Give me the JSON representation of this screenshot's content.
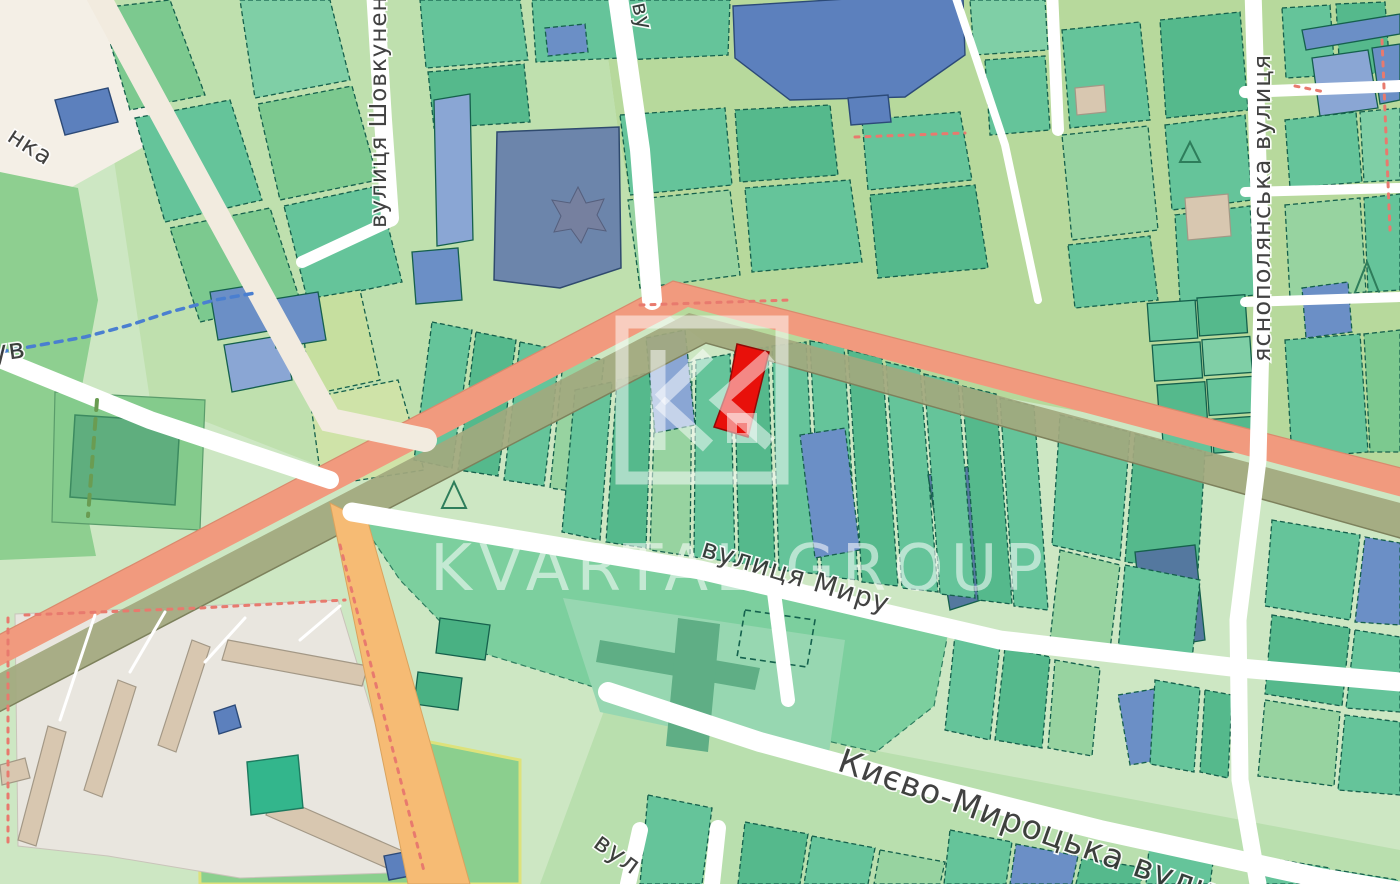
{
  "watermark": {
    "text": "KVARTAL GROUP",
    "logo_monogram": "KG"
  },
  "street_labels": {
    "street_bottom": "Києво-Мироцька вулиця",
    "street_middle": "вулиця Миру",
    "street_right_vertical": "яснополянська вулиця",
    "street_left_vertical": "вулиця Шовкуненка",
    "partial_top_left": "нка",
    "partial_left_edge": "ув",
    "partial_top_center": "ву",
    "partial_bottom": "вул"
  },
  "map_colors": {
    "highlighted_parcel": "#e8100a",
    "highway_fill": "#f19a7e",
    "highway_casing": "#a2a87e",
    "secondary_road": "#f6bb74",
    "local_road": "#ffffff",
    "parcel_border": "#15604c",
    "parcel_teal": "#65c49a",
    "parcel_blue": "#6b8fc6",
    "building_blue": "#5c80bd",
    "building_tan": "#d8c7b0",
    "base_green": "#cde7c3",
    "base_yellow_green": "#b7d99c",
    "watermark_color": "rgba(255,255,255,0.55)"
  }
}
